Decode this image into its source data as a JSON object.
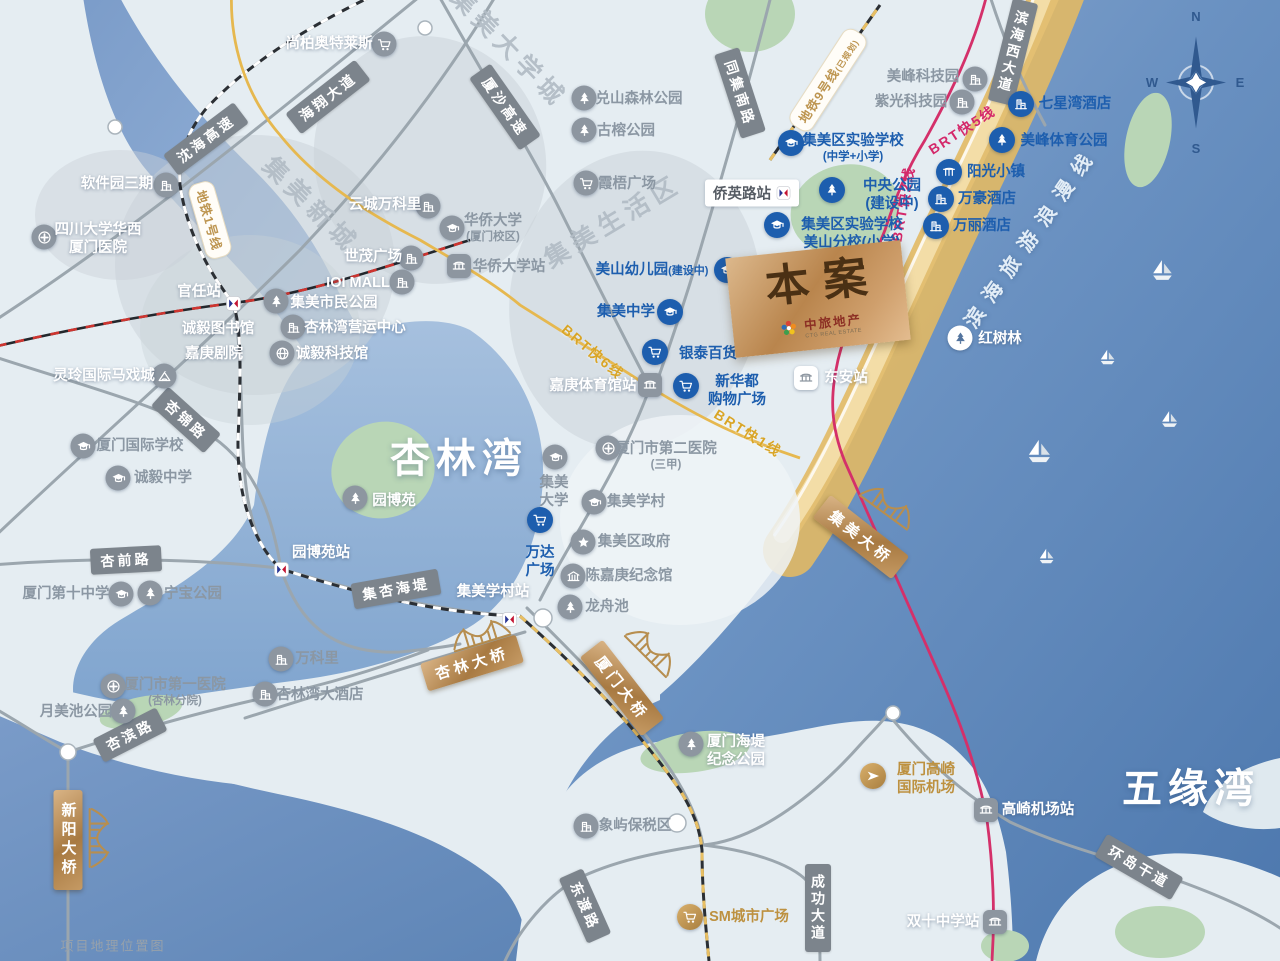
{
  "caption": "项目地理位置图",
  "project": {
    "label": "本案",
    "brand_cn": "中旅地产",
    "brand_en": "CTG REAL ESTATE"
  },
  "compass": {
    "north": "N",
    "east": "E",
    "south": "S",
    "west": "W"
  },
  "colors": {
    "poi_blue": "#1d5eae",
    "poi_gray": "#8b97a3",
    "gold": "#bd9140",
    "brt_gold_line": "#e6b84f",
    "brt_pink_line": "#d4306a",
    "road_label_bg": "#7c848c",
    "bridge_gold": "#b9854d"
  },
  "water_labels": [
    {
      "text": "杏林湾",
      "x": 459,
      "y": 455,
      "rot": 0,
      "cls": "water-big"
    },
    {
      "text": "五缘湾",
      "x": 1191,
      "y": 785,
      "rot": 0,
      "cls": "water-big"
    },
    {
      "text": "滨海旅游浪漫线",
      "x": 1030,
      "y": 236,
      "rot": -55,
      "cls": "coastline"
    }
  ],
  "district_labels": [
    {
      "text": "集美大学城",
      "x": 510,
      "y": 47,
      "rot": 46
    },
    {
      "text": "集美新城",
      "x": 312,
      "y": 204,
      "rot": 45
    },
    {
      "text": "集美生活区",
      "x": 612,
      "y": 220,
      "rot": -31
    }
  ],
  "road_labels": [
    {
      "text": "沈海高速",
      "x": 206,
      "y": 139,
      "rot": -37
    },
    {
      "text": "海翔大道",
      "x": 328,
      "y": 97,
      "rot": -38
    },
    {
      "text": "厦沙高速",
      "x": 505,
      "y": 107,
      "rot": 55
    },
    {
      "text": "同集南路",
      "x": 740,
      "y": 93,
      "rot": 72
    },
    {
      "text": "滨海西大道",
      "x": 1013,
      "y": 52,
      "rot": 14,
      "vert": true
    },
    {
      "text": "杏锦路",
      "x": 186,
      "y": 420,
      "rot": 42
    },
    {
      "text": "杏前路",
      "x": 126,
      "y": 560,
      "rot": -3
    },
    {
      "text": "杏滨路",
      "x": 130,
      "y": 735,
      "rot": -27
    },
    {
      "text": "集杏海堤",
      "x": 396,
      "y": 589,
      "rot": -10
    },
    {
      "text": "东渡路",
      "x": 585,
      "y": 906,
      "rot": 66
    },
    {
      "text": "成功大道",
      "x": 818,
      "y": 908,
      "rot": 0,
      "vert": true
    },
    {
      "text": "环岛干道",
      "x": 1139,
      "y": 867,
      "rot": 30
    }
  ],
  "transit_labels": [
    {
      "text": "地铁1号线",
      "x": 210,
      "y": 220,
      "rot": 74,
      "cls": "mbadge"
    },
    {
      "text": "地铁9号线",
      "tail": "(已规划)",
      "x": 828,
      "y": 80,
      "rot": -57,
      "cls": "mbadge"
    },
    {
      "text": "BRT快6线",
      "x": 593,
      "y": 352,
      "rot": 40,
      "cls": "brt-gold"
    },
    {
      "text": "BRT快1线",
      "x": 748,
      "y": 433,
      "rot": 32,
      "cls": "brt-gold"
    },
    {
      "text": "BRT快5线",
      "x": 962,
      "y": 130,
      "rot": -33,
      "cls": "brt-pink"
    },
    {
      "text": "BRT快2线",
      "x": 903,
      "y": 204,
      "rot": -80,
      "cls": "brt-pink"
    }
  ],
  "bridges": [
    {
      "text": "新阳大桥",
      "x": 68,
      "y": 840,
      "rot": 0,
      "vert": true,
      "ix": 99,
      "iy": 838,
      "irot": 90
    },
    {
      "text": "杏林大桥",
      "x": 472,
      "y": 663,
      "rot": -17,
      "ix": 480,
      "iy": 634,
      "irot": -17
    },
    {
      "text": "厦门大桥",
      "x": 622,
      "y": 688,
      "rot": 52,
      "ix": 652,
      "iy": 650,
      "irot": 45
    },
    {
      "text": "集美大桥",
      "x": 861,
      "y": 537,
      "rot": 38,
      "ix": 889,
      "iy": 505,
      "irot": 36
    }
  ],
  "stations": [
    {
      "text": "官任站",
      "type": "metro",
      "x": 233,
      "y": 303,
      "lx": 199,
      "ly": 292,
      "lc": "c-w"
    },
    {
      "text": "园博苑站",
      "type": "metro",
      "x": 281,
      "y": 569,
      "lx": 321,
      "ly": 553,
      "lc": "c-w"
    },
    {
      "text": "集美学村站",
      "type": "metro",
      "x": 509,
      "y": 619,
      "lx": 493,
      "ly": 592,
      "lc": "c-w"
    },
    {
      "text": "侨英路站",
      "type": "box",
      "x": 752,
      "y": 193
    },
    {
      "text": "华侨大学站",
      "type": "brt",
      "x": 459,
      "y": 266,
      "lx": 509,
      "ly": 267,
      "lc": "c-g"
    },
    {
      "text": "嘉庚体育馆站",
      "type": "brt",
      "x": 650,
      "y": 385,
      "lx": 593,
      "ly": 386,
      "lc": "c-w"
    },
    {
      "text": "东安站",
      "type": "brtw",
      "x": 806,
      "y": 378,
      "lx": 846,
      "ly": 378,
      "lc": "c-w"
    },
    {
      "text": "高崎机场站",
      "type": "brt",
      "x": 986,
      "y": 810,
      "lx": 1038,
      "ly": 810,
      "lc": "c-w"
    },
    {
      "text": "双十中学站",
      "type": "brt",
      "x": 995,
      "y": 922,
      "lx": 943,
      "ly": 922,
      "lc": "c-w"
    }
  ],
  "pois": [
    {
      "t": "集美区实验学校",
      "sub": "(中学+小学)",
      "icon": "grad",
      "ix": 791,
      "iy": 143,
      "lx": 853,
      "ly": 148,
      "c": "b"
    },
    {
      "t": "集美区实验学校",
      "sub": "美山分校(小学)",
      "bs": true,
      "icon": "grad",
      "ix": 777,
      "iy": 225,
      "lx": 852,
      "ly": 234,
      "c": "b"
    },
    {
      "t": "中央公园",
      "sub": "(建设中)",
      "bs": true,
      "icon": "tree",
      "ix": 832,
      "iy": 190,
      "lx": 892,
      "ly": 195,
      "c": "b"
    },
    {
      "t": "美山幼儿园",
      "tail": "(建设中)",
      "icon": "grad",
      "ix": 727,
      "iy": 270,
      "lx": 652,
      "ly": 270,
      "c": "b"
    },
    {
      "t": "集美中学",
      "icon": "grad",
      "ix": 670,
      "iy": 312,
      "lx": 626,
      "ly": 312,
      "c": "b"
    },
    {
      "t": "银泰百货",
      "icon": "cart",
      "ix": 655,
      "iy": 352,
      "lx": 708,
      "ly": 354,
      "c": "b"
    },
    {
      "t": "新华都",
      "sub": "购物广场",
      "bs": true,
      "icon": "cart",
      "ix": 686,
      "iy": 386,
      "lx": 737,
      "ly": 391,
      "c": "b"
    },
    {
      "t": "万达",
      "sub": "广场",
      "bs": true,
      "icon": "cart",
      "ix": 540,
      "iy": 520,
      "lx": 540,
      "ly": 562,
      "c": "b"
    },
    {
      "t": "七星湾酒店",
      "icon": "bldg",
      "ix": 1021,
      "iy": 104,
      "lx": 1075,
      "ly": 104,
      "c": "b"
    },
    {
      "t": "美峰体育公园",
      "icon": "tree",
      "ix": 1002,
      "iy": 140,
      "lx": 1064,
      "ly": 141,
      "c": "b"
    },
    {
      "t": "阳光小镇",
      "icon": "gate",
      "ix": 949,
      "iy": 172,
      "lx": 996,
      "ly": 172,
      "c": "b"
    },
    {
      "t": "万豪酒店",
      "icon": "bldg",
      "ix": 941,
      "iy": 199,
      "lx": 987,
      "ly": 199,
      "c": "b"
    },
    {
      "t": "万丽酒店",
      "icon": "bldg",
      "ix": 936,
      "iy": 226,
      "lx": 982,
      "ly": 226,
      "c": "b"
    },
    {
      "t": "软件园三期",
      "icon": "bldg",
      "ix": 166,
      "iy": 185,
      "lx": 117,
      "ly": 184,
      "c": "w",
      "iside": "r"
    },
    {
      "t": "四川大学华西",
      "sub": "厦门医院",
      "bs": true,
      "icon": "hosp",
      "ix": 44,
      "iy": 237,
      "lx": 98,
      "ly": 239,
      "c": "w"
    },
    {
      "t": "尚柏奥特莱斯",
      "icon": "cart",
      "ix": 384,
      "iy": 44,
      "lx": 329,
      "ly": 44,
      "c": "w",
      "iside": "r"
    },
    {
      "t": "云城万科里",
      "icon": "bldg",
      "ix": 428,
      "iy": 206,
      "lx": 385,
      "ly": 205,
      "c": "w",
      "iside": "r"
    },
    {
      "t": "世茂广场",
      "icon": "bldg",
      "ix": 411,
      "iy": 258,
      "lx": 373,
      "ly": 257,
      "c": "w",
      "iside": "r"
    },
    {
      "t": "IOI MALL",
      "icon": "bldg",
      "ix": 402,
      "iy": 282,
      "lx": 358,
      "ly": 283,
      "c": "w",
      "iside": "r"
    },
    {
      "t": "诚毅图书馆",
      "icon": "",
      "lx": 218,
      "ly": 329,
      "c": "w"
    },
    {
      "t": "嘉庚剧院",
      "icon": "",
      "lx": 214,
      "ly": 354,
      "c": "w"
    },
    {
      "t": "集美市民公园",
      "icon": "tree",
      "ix": 276,
      "iy": 301,
      "lx": 334,
      "ly": 303,
      "c": "w"
    },
    {
      "t": "杏林湾营运中心",
      "icon": "bldg",
      "ix": 293,
      "iy": 327,
      "lx": 355,
      "ly": 328,
      "c": "w"
    },
    {
      "t": "诚毅科技馆",
      "icon": "globe",
      "ix": 282,
      "iy": 353,
      "lx": 332,
      "ly": 354,
      "c": "w"
    },
    {
      "t": "灵玲国际马戏城",
      "icon": "tent",
      "ix": 164,
      "iy": 376,
      "lx": 104,
      "ly": 376,
      "c": "w",
      "iside": "r"
    },
    {
      "t": "园博苑",
      "icon": "tree",
      "ix": 355,
      "iy": 498,
      "lx": 394,
      "ly": 501,
      "c": "w"
    },
    {
      "t": "红树林",
      "icon": "tree",
      "ix": 960,
      "iy": 338,
      "lx": 1000,
      "ly": 339,
      "c": "w",
      "icls": "ic-w"
    },
    {
      "t": "厦门海堤",
      "sub": "纪念公园",
      "bs": true,
      "icon": "tree",
      "ix": 691,
      "iy": 744,
      "lx": 736,
      "ly": 751,
      "c": "w"
    },
    {
      "t": "美峰科技园",
      "icon": "bldg",
      "ix": 975,
      "iy": 79,
      "lx": 923,
      "ly": 77,
      "c": "g",
      "iside": "r"
    },
    {
      "t": "紫光科技园",
      "icon": "bldg",
      "ix": 962,
      "iy": 102,
      "lx": 911,
      "ly": 102,
      "c": "g",
      "iside": "r"
    },
    {
      "t": "兑山森林公园",
      "icon": "tree",
      "ix": 584,
      "iy": 98,
      "lx": 639,
      "ly": 99,
      "c": "g"
    },
    {
      "t": "古榕公园",
      "icon": "tree",
      "ix": 584,
      "iy": 130,
      "lx": 626,
      "ly": 131,
      "c": "g"
    },
    {
      "t": "霞梧广场",
      "icon": "cart",
      "ix": 586,
      "iy": 183,
      "lx": 627,
      "ly": 184,
      "c": "g"
    },
    {
      "t": "华侨大学",
      "sub": "(厦门校区)",
      "icon": "grad",
      "ix": 452,
      "iy": 228,
      "lx": 493,
      "ly": 228,
      "c": "g"
    },
    {
      "t": "厦门国际学校",
      "icon": "grad",
      "ix": 83,
      "iy": 446,
      "lx": 140,
      "ly": 446,
      "c": "g"
    },
    {
      "t": "诚毅中学",
      "icon": "grad",
      "ix": 118,
      "iy": 478,
      "lx": 163,
      "ly": 478,
      "c": "g"
    },
    {
      "t": "厦门第十中学",
      "icon": "grad",
      "ix": 121,
      "iy": 594,
      "lx": 66,
      "ly": 594,
      "c": "g",
      "iside": "r"
    },
    {
      "t": "宁宝公园",
      "icon": "tree",
      "ix": 150,
      "iy": 593,
      "lx": 193,
      "ly": 594,
      "c": "g"
    },
    {
      "t": "月美池公园",
      "icon": "tree",
      "ix": 123,
      "iy": 711,
      "lx": 76,
      "ly": 712,
      "c": "g",
      "iside": "r"
    },
    {
      "t": "厦门市第一医院",
      "sub": "(杏林分院)",
      "icon": "hosp",
      "ix": 113,
      "iy": 686,
      "lx": 175,
      "ly": 692,
      "c": "g"
    },
    {
      "t": "万科里",
      "icon": "bldg",
      "ix": 281,
      "iy": 659,
      "lx": 317,
      "ly": 659,
      "c": "g"
    },
    {
      "t": "杏林湾大酒店",
      "icon": "bldg",
      "ix": 265,
      "iy": 694,
      "lx": 320,
      "ly": 695,
      "c": "g"
    },
    {
      "t": "集美",
      "sub": "大学",
      "bs": true,
      "icon": "grad",
      "ix": 555,
      "iy": 457,
      "lx": 554,
      "ly": 492,
      "c": "g"
    },
    {
      "t": "集美学村",
      "icon": "grad",
      "ix": 594,
      "iy": 502,
      "lx": 636,
      "ly": 502,
      "c": "g"
    },
    {
      "t": "集美区政府",
      "icon": "star",
      "ix": 583,
      "iy": 542,
      "lx": 634,
      "ly": 542,
      "c": "g"
    },
    {
      "t": "陈嘉庚纪念馆",
      "icon": "museum",
      "ix": 573,
      "iy": 576,
      "lx": 629,
      "ly": 576,
      "c": "g"
    },
    {
      "t": "龙舟池",
      "icon": "tree",
      "ix": 570,
      "iy": 607,
      "lx": 607,
      "ly": 607,
      "c": "g"
    },
    {
      "t": "厦门市第二医院",
      "sub": "(三甲)",
      "icon": "hosp",
      "ix": 608,
      "iy": 448,
      "lx": 666,
      "ly": 456,
      "c": "g"
    },
    {
      "t": "象屿保税区",
      "icon": "bldg",
      "ix": 586,
      "iy": 826,
      "lx": 635,
      "ly": 826,
      "c": "g"
    },
    {
      "t": "SM城市广场",
      "icon": "cart",
      "ix": 690,
      "iy": 917,
      "lx": 749,
      "ly": 917,
      "c": "gold",
      "icls": "ic-gold"
    },
    {
      "t": "厦门高崎",
      "sub": "国际机场",
      "bs": true,
      "icon": "plane",
      "ix": 873,
      "iy": 776,
      "lx": 926,
      "ly": 779,
      "c": "gold",
      "icls": "ic-gold"
    }
  ],
  "boats": [
    {
      "x": 1163,
      "y": 270,
      "s": 15
    },
    {
      "x": 1108,
      "y": 357,
      "s": 11
    },
    {
      "x": 1170,
      "y": 419,
      "s": 12
    },
    {
      "x": 1040,
      "y": 451,
      "s": 17
    },
    {
      "x": 1047,
      "y": 556,
      "s": 11
    }
  ]
}
